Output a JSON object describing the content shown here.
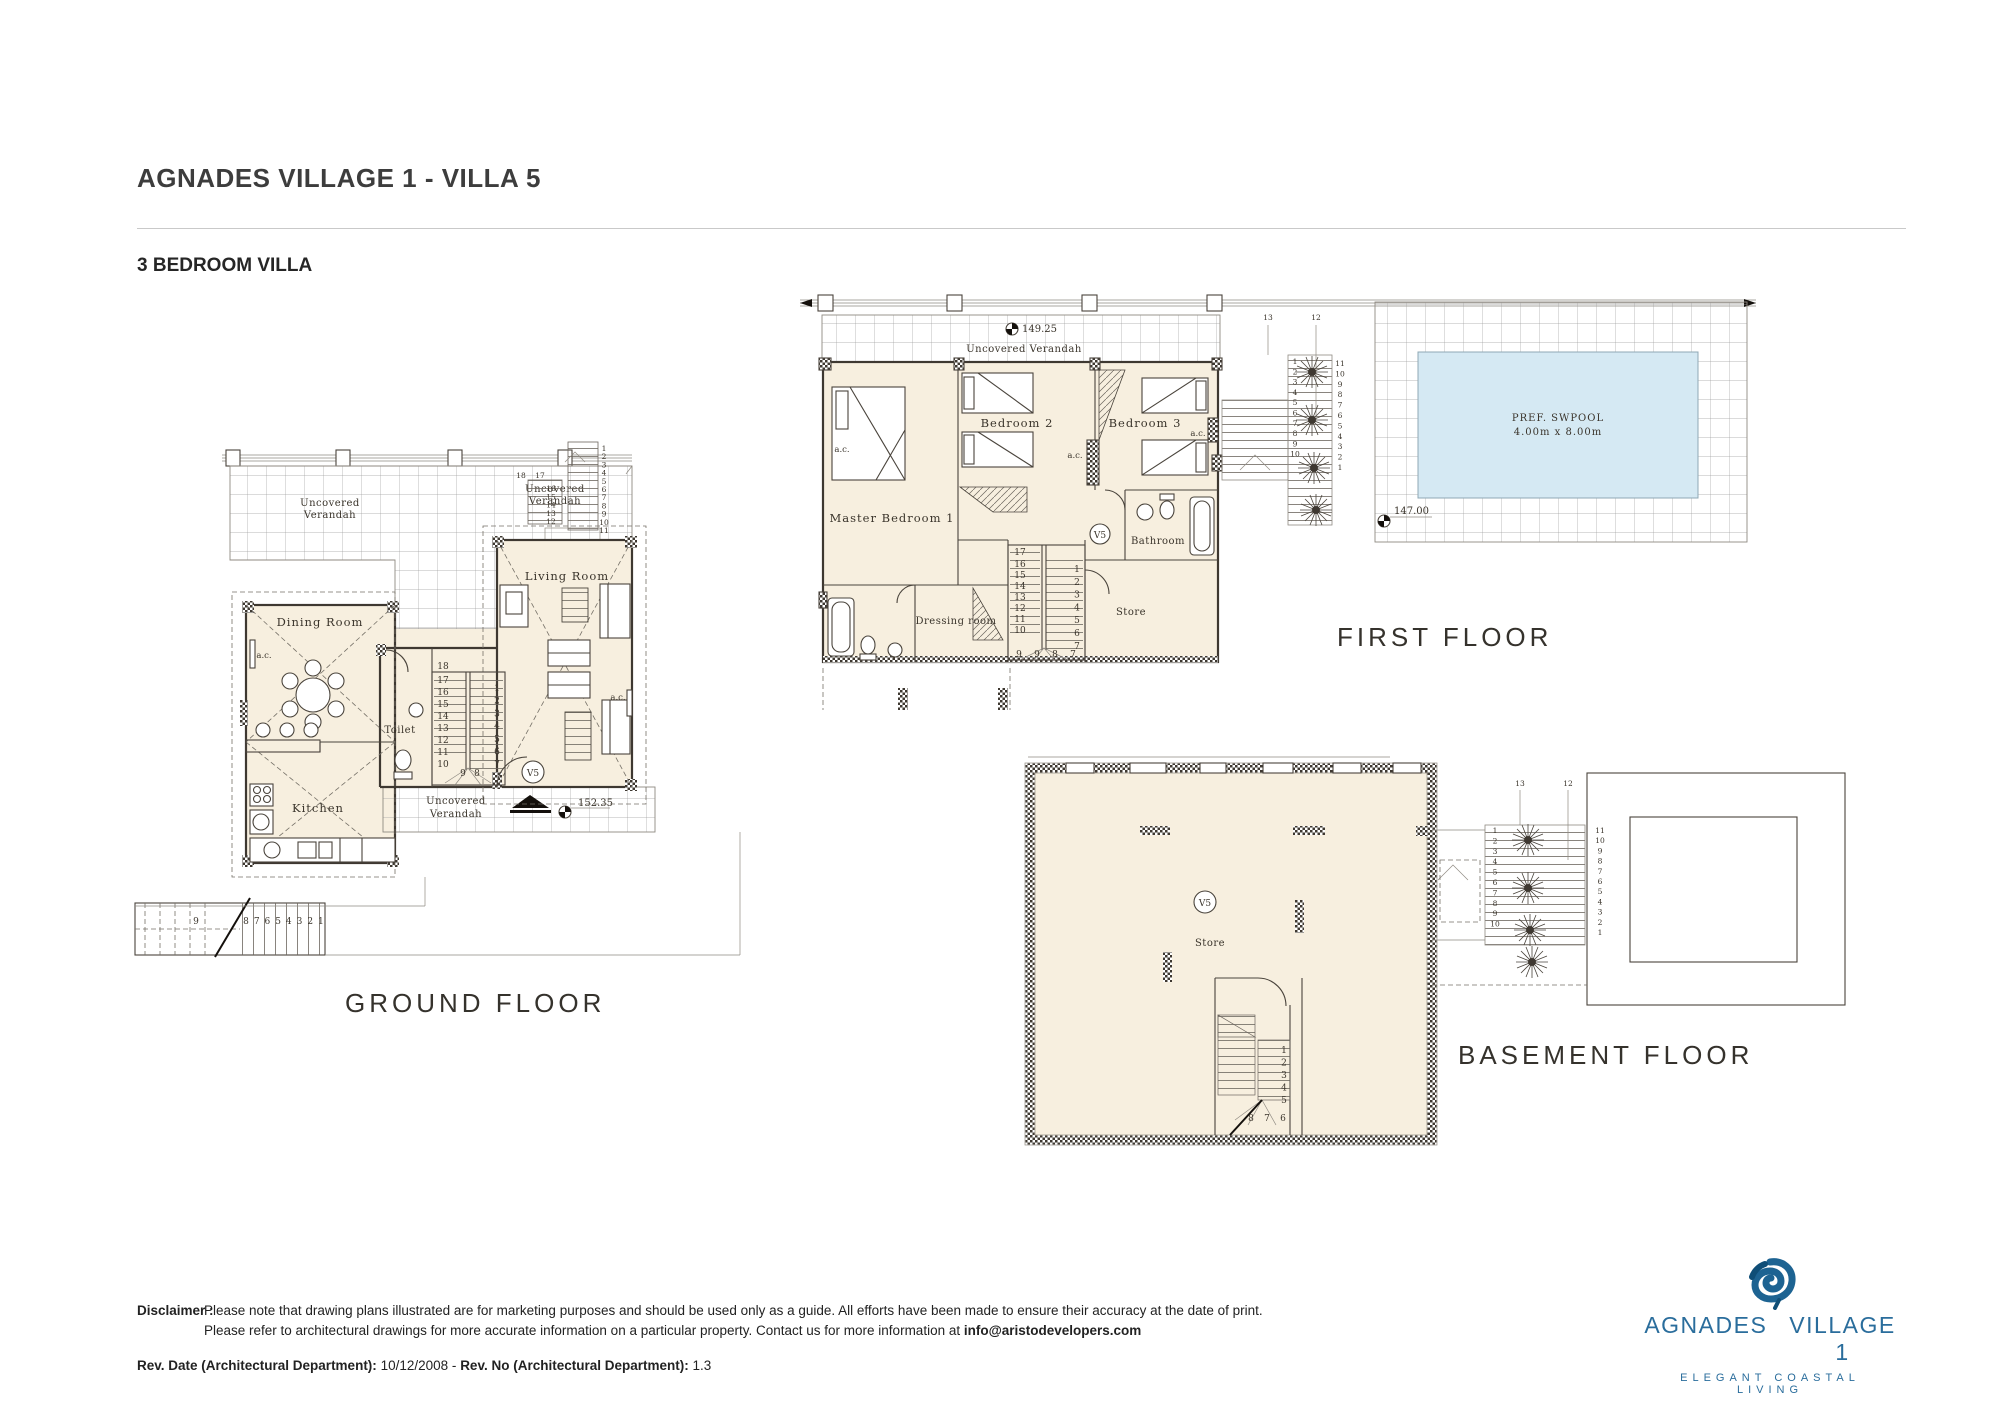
{
  "header": {
    "title": "AGNADES VILLAGE 1 - VILLA 5",
    "subtitle": "3 BEDROOM VILLA"
  },
  "plans": {
    "verandah_line1": "Uncovered",
    "verandah_line2": "Verandah",
    "verandah_full": "Uncovered Verandah",
    "unit_tag": "V5",
    "ac": "a.c.",
    "ground": {
      "caption": "GROUND FLOOR",
      "rooms": {
        "dining": "Dining Room",
        "living": "Living Room",
        "kitchen": "Kitchen",
        "toilet": "Toilet"
      },
      "level": "152.35",
      "stair_top": "18",
      "stair_left": [
        "17",
        "16",
        "15",
        "14",
        "13",
        "12",
        "11",
        "10"
      ],
      "stair_bottom": [
        "9",
        "8"
      ],
      "stair_right": [
        "1",
        "2",
        "3",
        "4",
        "5",
        "6",
        "7"
      ],
      "ext_top_labels": [
        "18",
        "17"
      ],
      "ext_mid": [
        "16",
        "15",
        "14",
        "13",
        "12"
      ],
      "ext_right_col": [
        "1",
        "2",
        "3",
        "4",
        "5",
        "6",
        "7",
        "8",
        "9",
        "10",
        "11"
      ],
      "ext_bottom_first": "9",
      "ext_bottom_row": [
        "8",
        "7",
        "6",
        "5",
        "4",
        "3",
        "2",
        "1"
      ]
    },
    "first": {
      "caption": "FIRST FLOOR",
      "rooms": {
        "master": "Master Bedroom 1",
        "bed2": "Bedroom 2",
        "bed3": "Bedroom 3",
        "bath": "Bathroom",
        "dressing": "Dressing room",
        "store": "Store"
      },
      "level_top": "149.25",
      "pool_line1": "PREF. SWPOOL",
      "pool_line2": "4.00m x 8.00m",
      "pool_level": "147.00",
      "stair_top": "17",
      "stair_left": [
        "16",
        "15",
        "14",
        "13",
        "12",
        "11",
        "10"
      ],
      "stair_bottom": [
        "9",
        "9",
        "8",
        "7"
      ],
      "stair_right": [
        "1",
        "2",
        "3",
        "4",
        "5",
        "6",
        "7"
      ],
      "ext_top_labels": [
        "13",
        "12"
      ],
      "ext_left_col": [
        "1",
        "2",
        "3",
        "4",
        "5",
        "6",
        "7",
        "8",
        "9",
        "10"
      ],
      "ext_right_col": [
        "11",
        "10",
        "9",
        "8",
        "7",
        "6",
        "5",
        "4",
        "3",
        "2",
        "1"
      ]
    },
    "basement": {
      "caption": "BASEMENT FLOOR",
      "rooms": {
        "store": "Store"
      },
      "stair_right": [
        "1",
        "2",
        "3",
        "4",
        "5"
      ],
      "stair_bottom": [
        "8",
        "7",
        "6"
      ],
      "ext_top_labels": [
        "13",
        "12"
      ],
      "ext_left_col": [
        "1",
        "2",
        "3",
        "4",
        "5",
        "6",
        "7",
        "8",
        "9",
        "10"
      ],
      "ext_right_col": [
        "11",
        "10",
        "9",
        "8",
        "7",
        "6",
        "5",
        "4",
        "3",
        "2",
        "1"
      ]
    }
  },
  "icons": {
    "logo": "shell-icon",
    "level_marker": "level-marker-icon",
    "entrance": "entrance-arrow-icon",
    "plant": "plant-icon"
  },
  "colors": {
    "cream": "#f7efdf",
    "wall": "#3e3831",
    "pool_blue": "#d5e9f3",
    "logo_blue": "#2a6d9c"
  },
  "footer": {
    "disclaimer_label": "Disclaimer :",
    "disclaimer_line1": "Please note that drawing plans illustrated are for marketing purposes and should be used only as a guide. All efforts have been made to ensure their accuracy at the date of print.",
    "disclaimer_line2_pre": "Please refer to architectural drawings for more accurate information on a particular property. Contact us for more information at ",
    "disclaimer_email": "info@aristodevelopers.com",
    "rev_date_label": "Rev. Date (Architectural Department):",
    "rev_date_value": "10/12/2008",
    "rev_separator": "-",
    "rev_no_label": "Rev. No (Architectural Department):",
    "rev_no_value": "1.3"
  },
  "logo": {
    "name_left": "AGNADES",
    "name_right": "VILLAGE 1",
    "tagline": "ELEGANT COASTAL LIVING"
  }
}
